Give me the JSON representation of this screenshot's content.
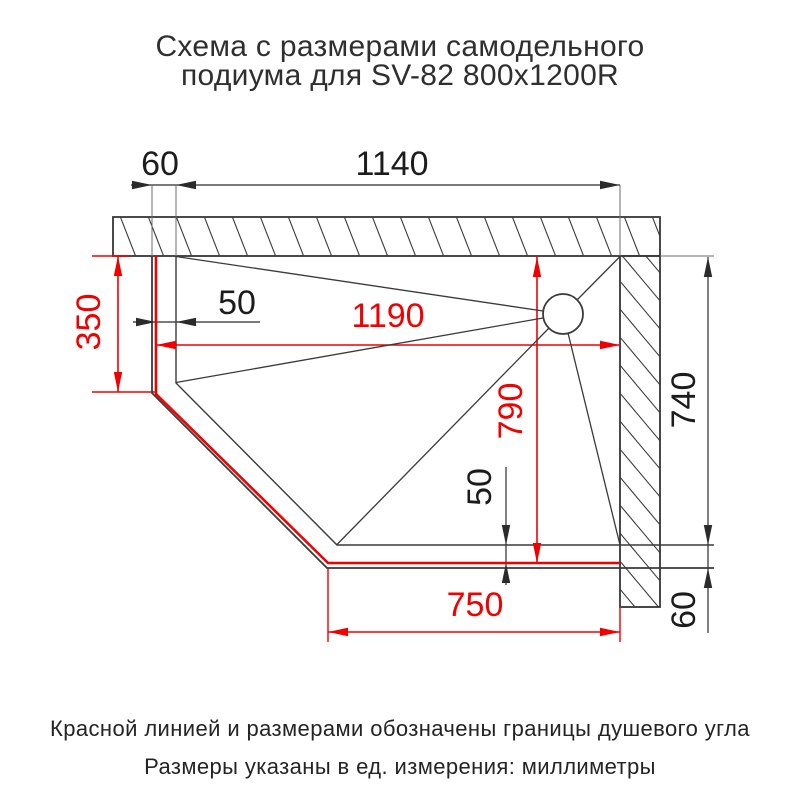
{
  "title": {
    "line1": "Схема с размерами самодельного",
    "line2": "подиума для SV-82 800x1200R"
  },
  "dimensions": {
    "top_curb_width": "60",
    "top_inner_width": "1140",
    "left_red_height": "350",
    "left_red_to_inner": "50",
    "red_width": "1190",
    "red_depth": "790",
    "right_inner_depth": "740",
    "bottom_inner_to_red": "50",
    "bottom_red_width": "750",
    "bottom_curb_width": "60"
  },
  "footer": {
    "line1": "Красной линией и размерами обозначены границы душевого угла",
    "line2": "Размеры указаны в ед. измерения: миллиметры"
  },
  "colors": {
    "red": "#f20000",
    "line": "#3a3a3a",
    "ink": "#1c1c1c"
  }
}
